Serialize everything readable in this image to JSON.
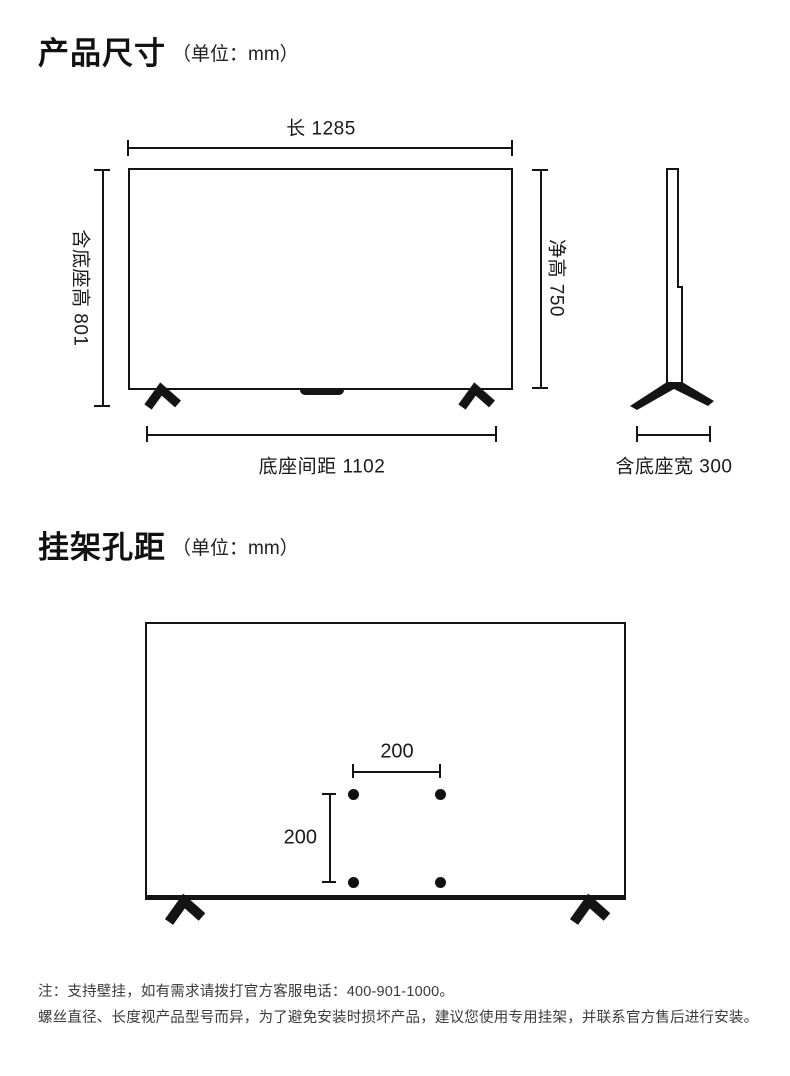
{
  "colors": {
    "background": "#ffffff",
    "line": "#141414",
    "text": "#1a1a1a",
    "note_text": "#3b3b3b"
  },
  "sections": {
    "product_size": {
      "title": "产品尺寸",
      "unit": "（单位：mm）",
      "front_view": {
        "length_label": "长 1285",
        "height_with_base_label": "含底座高 801",
        "net_height_label": "净高 750",
        "base_distance_label": "底座间距 1102"
      },
      "side_view": {
        "width_with_base_label": "含底座宽 300"
      }
    },
    "mount_holes": {
      "title": "挂架孔距",
      "unit": "（单位：mm）",
      "hole_spacing_horizontal": "200",
      "hole_spacing_vertical": "200"
    }
  },
  "notes": {
    "line1": "注：支持壁挂，如有需求请拨打官方客服电话：400-901-1000。",
    "line2": "螺丝直径、长度视产品型号而异，为了避免安装时损坏产品，建议您使用专用挂架，并联系官方售后进行安装。"
  }
}
